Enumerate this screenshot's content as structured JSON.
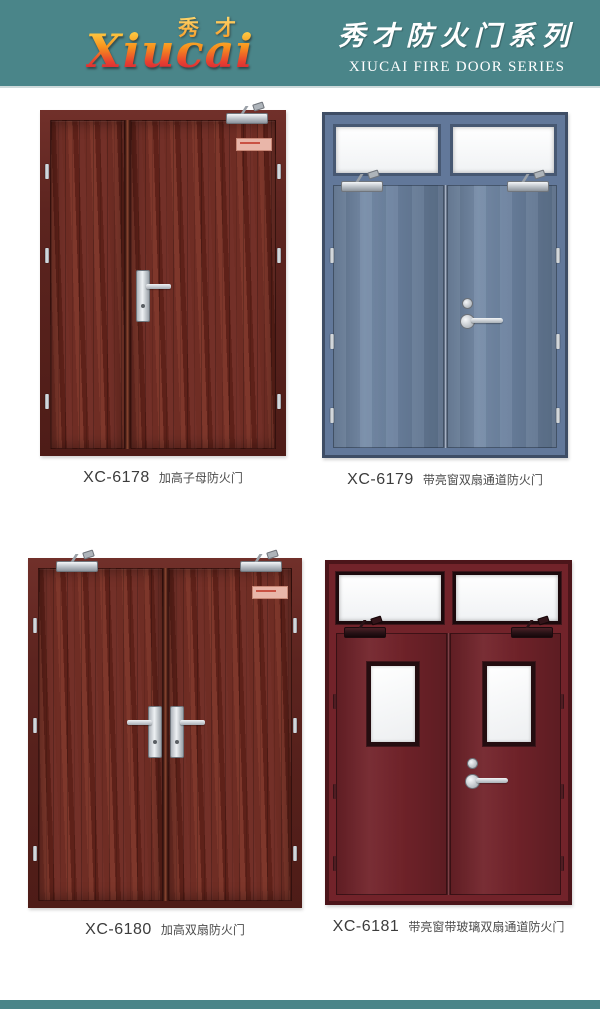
{
  "header": {
    "logo_cn": "秀才",
    "logo_latin": "Xiucai",
    "series_cn": "秀才防火门系列",
    "series_en": "XIUCAI FIRE DOOR SERIES"
  },
  "products": [
    {
      "model": "XC-6178",
      "name": "加高子母防火门"
    },
    {
      "model": "XC-6179",
      "name": "带亮窗双扇通道防火门"
    },
    {
      "model": "XC-6180",
      "name": "加高双扇防火门"
    },
    {
      "model": "XC-6181",
      "name": "带亮窗带玻璃双扇通道防火门"
    }
  ],
  "colors": {
    "header-teal": "#4A8589",
    "logo-gradient-top": "#FFD84D",
    "logo-gradient-bottom": "#C2123F",
    "wood-door": "#6B2A23",
    "wood-frame": "#5C241F",
    "blue-door": "#6C83A1",
    "blue-frame": "#3E4D65",
    "maroon-door": "#72232A",
    "maroon-frame": "#4C151A",
    "hardware-silver": "#D6D9DD",
    "label-text": "#3C3C3C"
  }
}
